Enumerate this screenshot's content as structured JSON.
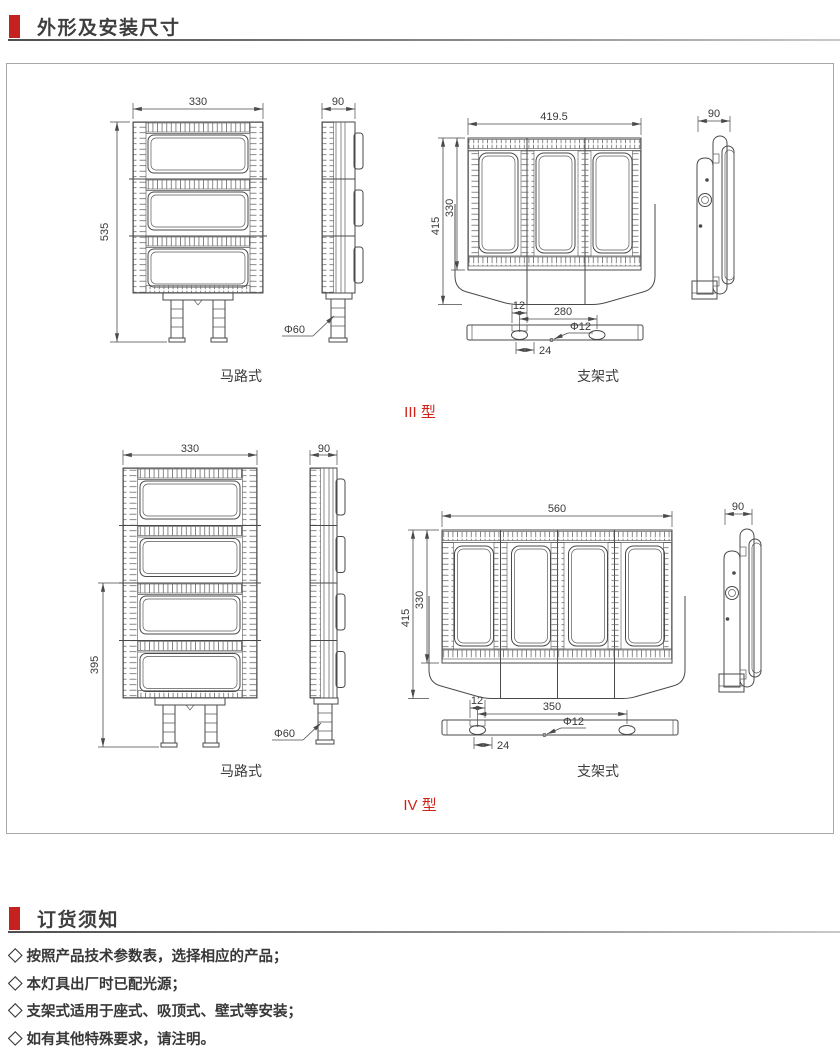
{
  "headers": {
    "dimensions": "外形及安装尺寸",
    "ordering": "订货须知"
  },
  "figures": {
    "row1": {
      "type_label": "III 型",
      "road_label": "马路式",
      "bracket_label": "支架式",
      "road": {
        "width": "330",
        "height": "535",
        "side_width": "90",
        "pole_dia": "Φ60"
      },
      "bracket": {
        "width": "419.5",
        "total_height": "415",
        "inner_height": "330",
        "side_width": "90",
        "hole_offset": "12",
        "hole_span": "280",
        "hole_dia": "Φ12",
        "slot_width": "24"
      }
    },
    "row2": {
      "type_label": "IV 型",
      "road_label": "马路式",
      "bracket_label": "支架式",
      "road": {
        "width": "330",
        "height": "395",
        "side_width": "90",
        "pole_dia": "Φ60"
      },
      "bracket": {
        "width": "560",
        "total_height": "415",
        "inner_height": "330",
        "side_width": "90",
        "hole_offset": "12",
        "hole_span": "350",
        "hole_dia": "Φ12",
        "slot_width": "24"
      }
    }
  },
  "notes": {
    "items": [
      "◇ 按照产品技术参数表，选择相应的产品；",
      "◇ 本灯具出厂时已配光源；",
      "◇ 支架式适用于座式、吸顶式、壁式等安装；",
      "◇ 如有其他特殊要求，请注明。"
    ]
  },
  "colors": {
    "accent_red": "#c5211f",
    "type_red": "#cf2318",
    "line": "#4a4a4a"
  }
}
